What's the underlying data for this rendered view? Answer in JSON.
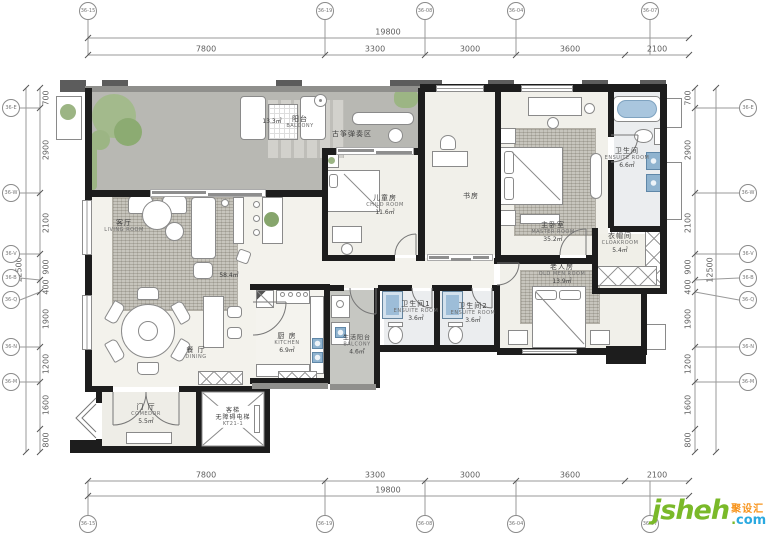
{
  "colors": {
    "wall": "#1d1d1d",
    "balcony_floor": "#b8b8b3",
    "room_floor": "#f1f0ea",
    "bath_floor": "#ebedef",
    "fixture_blue": "#8fb3cf",
    "plant_green": "#9cb584",
    "logo_green": "#7ab929",
    "logo_blue": "#2aa9e0",
    "logo_orange": "#f7941d"
  },
  "dims": {
    "top": {
      "total": "19800",
      "segments": [
        "7800",
        "3300",
        "3000",
        "3600",
        "2100"
      ]
    },
    "bottom": {
      "total": "19800",
      "segments": [
        "7800",
        "3300",
        "3000",
        "3600",
        "2100"
      ]
    },
    "left": {
      "total": "12500",
      "segments": [
        "700",
        "2900",
        "2100",
        "900",
        "400",
        "1900",
        "1200",
        "1600",
        "800"
      ]
    },
    "right": {
      "total": "12500",
      "segments": [
        "700",
        "2900",
        "2100",
        "900",
        "400",
        "1900",
        "1200",
        "1600",
        "800"
      ]
    }
  },
  "grid": {
    "top": [
      "36-15",
      "36-19",
      "36-08",
      "36-04",
      "36-07"
    ],
    "bottom": [
      "36-15",
      "36-19",
      "36-08",
      "36-04",
      "36-07"
    ],
    "left": [
      "36-E",
      "36-W",
      "36-V",
      "36-B",
      "36-Q",
      "36-N",
      "36-M"
    ],
    "right": [
      "36-E",
      "36-W",
      "36-V",
      "36-B",
      "36-Q",
      "36-N",
      "36-M"
    ]
  },
  "rooms": {
    "balcony": {
      "cn": "阳台",
      "en": "BALCONY",
      "area": "13.3㎡"
    },
    "guzheng_zone": {
      "cn": "古筝弹奏区"
    },
    "living": {
      "cn": "客厅",
      "en": "LIVING ROOM"
    },
    "open_area": {
      "area": "58.4㎡"
    },
    "dining": {
      "cn": "餐 厅",
      "en": "DINING"
    },
    "kitchen": {
      "cn": "厨 房",
      "en": "KITCHEN",
      "area": "6.9㎡"
    },
    "child": {
      "cn": "儿童房",
      "en": "CHILD ROOM",
      "area": "11.6㎡"
    },
    "study": {
      "cn": "书房"
    },
    "master": {
      "cn": "主卧室",
      "en": "MASTER ROOM",
      "area": "35.2㎡"
    },
    "master_bath": {
      "cn": "卫生间",
      "en": "ENSUITE ROOM",
      "area": "6.6㎡"
    },
    "cloakroom": {
      "cn": "衣帽间",
      "en": "CLOAKROOM",
      "area": "5.4㎡"
    },
    "elder": {
      "cn": "老人房",
      "en": "OLD MEN ROOM",
      "area": "13.9㎡"
    },
    "bath1": {
      "cn": "卫生间1",
      "en": "ENSUITE ROOM",
      "area": "3.6㎡"
    },
    "bath2": {
      "cn": "卫生间2",
      "en": "ENSUITE ROOM",
      "area": "3.6㎡"
    },
    "service_balcony": {
      "cn": "生活阳台",
      "en": "BALCONY",
      "area": "4.6㎡"
    },
    "foyer": {
      "cn": "门 厅",
      "en": "COMEDOR",
      "area": "5.5㎡"
    },
    "elevator": {
      "line1": "客梯",
      "line2": "无障碍电梯",
      "line3": "KT21-1"
    }
  },
  "logo": {
    "brand": "jsheh",
    "dot": ".",
    "tld": "com",
    "cn_tag": "聚设汇"
  }
}
